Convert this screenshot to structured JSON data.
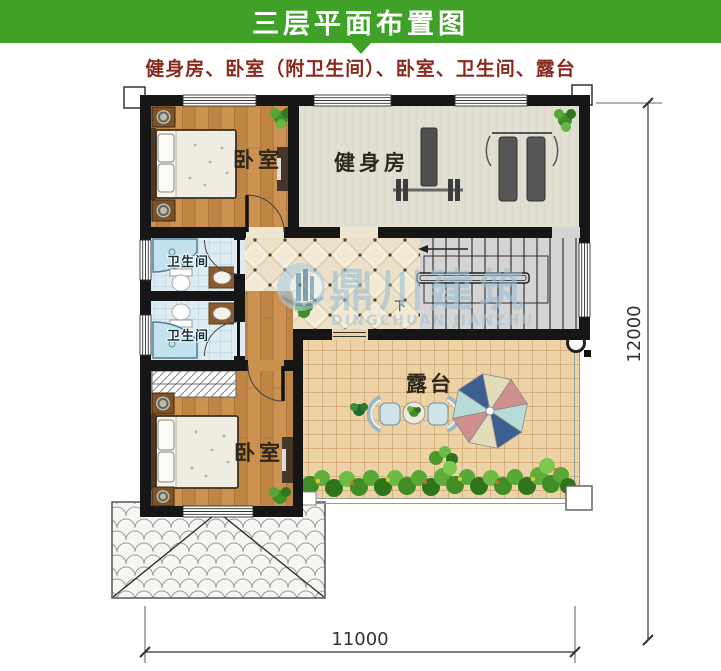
{
  "header": {
    "title": "三层平面布置图"
  },
  "subtitle": "健身房、卧室（附卫生间）、卧室、卫生间、露台",
  "plan": {
    "rooms": {
      "bedroom_top": "卧室",
      "gym": "健身房",
      "bathroom_top": "卫生间",
      "bathroom_bottom": "卫生间",
      "bedroom_bottom": "卧室",
      "terrace": "露台",
      "stairs_direction": "下"
    },
    "dimensions": {
      "bottom_width": "11000",
      "right_height": "12000"
    },
    "watermark": {
      "name_cn": "鼎川建筑",
      "name_en": "DINGCHUAN JIANZHU"
    }
  },
  "colors": {
    "header_green": "#3fa128",
    "subtitle_red": "#8a2a1e",
    "wall_black": "#161616",
    "wood_floor": "#c28947",
    "gym_floor": "#e1ded2",
    "hall_tile": "#ece1c8",
    "bath_tile": "#dcecf2",
    "terrace_tile": "#ecd2a4",
    "watermark_blue": "#9cc0d8"
  }
}
